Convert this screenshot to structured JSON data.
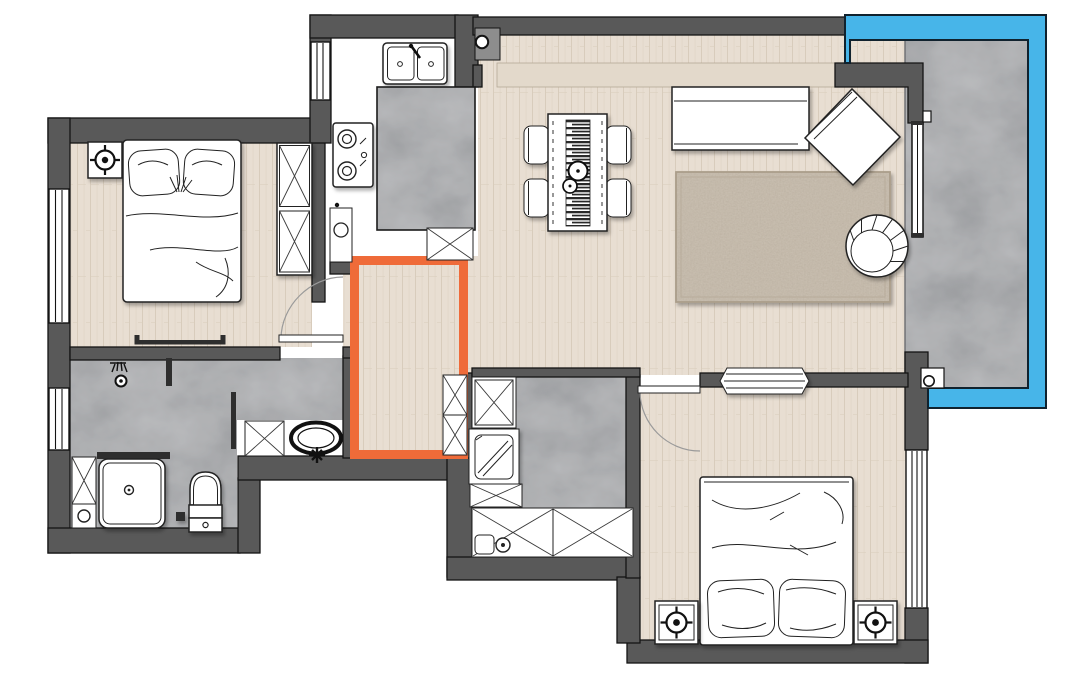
{
  "meta": {
    "kind": "apartment-floor-plan",
    "canvas_width": 1080,
    "canvas_height": 679,
    "visible_text": "none"
  },
  "palette": {
    "page_bg": "#ffffff",
    "wall": "#595959",
    "wall_outline": "#141414",
    "wood_floor": "#e8ded2",
    "wood_line": "#d8ccbc",
    "kitchen_floor": "#ffffff",
    "tile": "#bcbdbf",
    "tile_mottle": "#808286",
    "balcony_glass": "#47b5e9",
    "highlight": "#ef6b39",
    "rug": "#cdc3b5",
    "rug_speckle": "#a79b8a",
    "furniture_fill": "#ffffff",
    "line": "#222222"
  },
  "highlight_area": {
    "meaning": "selected-hallway-zone",
    "color": "#ef6b39"
  },
  "rooms": [
    {
      "id": "bedroom-1",
      "floor": "wood",
      "furniture": [
        "double-bed",
        "pillows",
        "nightstand",
        "downlight-symbol",
        "wardrobe-x2",
        "wall-shelf",
        "swing-door",
        "window"
      ]
    },
    {
      "id": "kitchen",
      "floor": "white",
      "furniture": [
        "double-sink",
        "faucet",
        "gas-hob-2-burner",
        "marble-island",
        "base-cabinet-round-basin",
        "storage-cabinet-x",
        "window",
        "entry-door-pivot"
      ]
    },
    {
      "id": "living-dining",
      "floor": "wood",
      "furniture": [
        "dining-table",
        "table-runner",
        "plates",
        "dining-chair",
        "dining-chair",
        "dining-chair",
        "dining-chair",
        "l-shaped-sofa",
        "angled-chaise",
        "area-rug",
        "round-armchair",
        "curtain-track"
      ]
    },
    {
      "id": "balcony",
      "floor": "marble-tile",
      "furniture": [
        "glass-enclosure",
        "sliding-glass-door",
        "floor-drain"
      ]
    },
    {
      "id": "hallway",
      "floor": "wood",
      "highlighted": true,
      "furniture": [
        "storage-cabinet-x",
        "storage-cabinet-x"
      ]
    },
    {
      "id": "bathroom",
      "floor": "marble-tile",
      "furniture": [
        "shower-head-symbol",
        "glass-screen",
        "shower-tray",
        "side-cabinet-x",
        "toilet",
        "vanity-cabinet-x",
        "countertop-basin",
        "faucet-symbol",
        "window"
      ]
    },
    {
      "id": "utility",
      "floor": "marble-tile",
      "furniture": [
        "storage-cabinet-x",
        "washing-machine",
        "low-cabinet-x",
        "counter-with-x-doors",
        "small-sink",
        "round-basin"
      ]
    },
    {
      "id": "bedroom-2",
      "floor": "wood",
      "furniture": [
        "double-bed",
        "pillows",
        "nightstand",
        "nightstand",
        "downlight-symbol",
        "downlight-symbol",
        "tv-console",
        "swing-door",
        "window"
      ]
    }
  ]
}
